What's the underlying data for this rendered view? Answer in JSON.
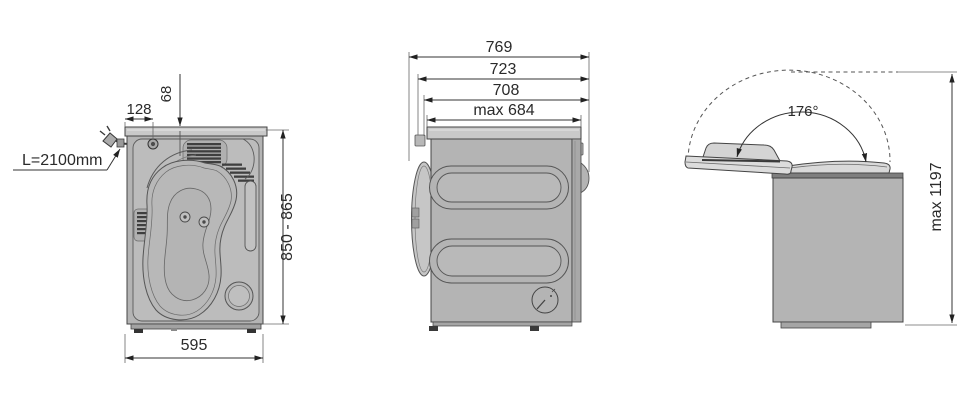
{
  "diagram": {
    "description": "Appliance (tumble dryer) installation dimension drawing with rear view, side view and open-lid view",
    "colors": {
      "background": "#ffffff",
      "body_gray": "#b4b4b4",
      "panel_gray": "#bcbcbc",
      "cap_gray": "#c9c9c9",
      "lid_gray": "#dadada",
      "vent_dark": "#3f3f3f",
      "outline": "#444444",
      "dimension_line": "#333333",
      "text": "#2a2a2a"
    },
    "rear_view": {
      "cord_length_label": "L=2100mm",
      "inlet_offset_x": "128",
      "inlet_offset_y": "68",
      "height_range": "850 - 865",
      "width": "595"
    },
    "side_view": {
      "depth_overall": "769",
      "depth_with_door": "723",
      "depth_body": "708",
      "depth_top": "max 684"
    },
    "lid_view": {
      "opening_angle": "176°",
      "max_height_lid_open": "max 1197"
    }
  }
}
